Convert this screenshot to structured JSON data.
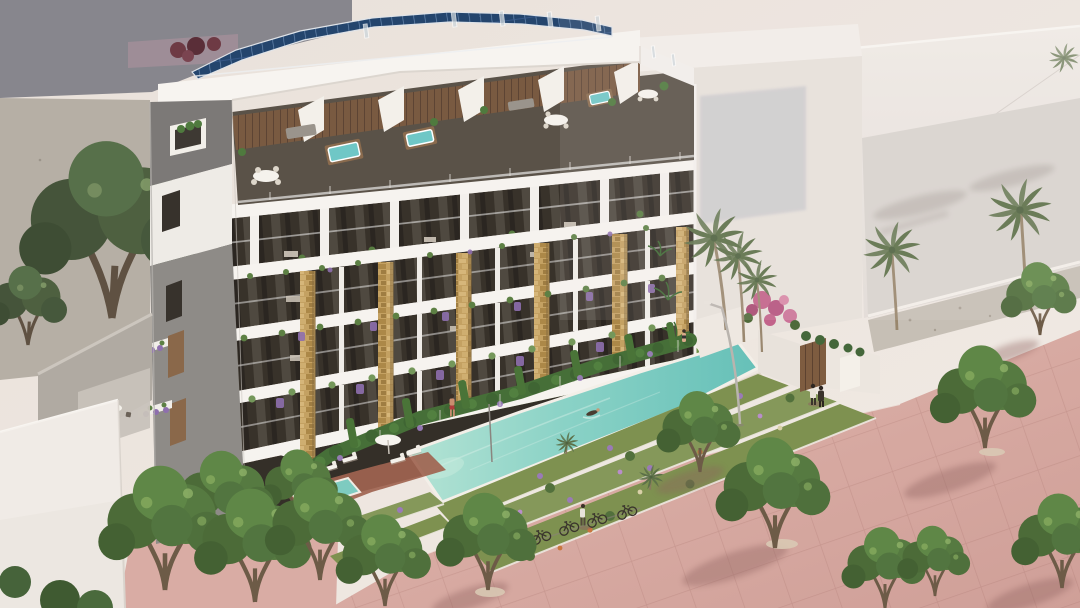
{
  "scene": {
    "title": "New-build apartment complex — aerial artist's impression",
    "description": "Artist's impression of a modern six-storey apartment building seen from above: rooftop solar panels, penthouse terraces with hot tubs and dining sets, balconies with lush planting between stone-clad pillars, a long turquoise lap pool beside a lawn with a swimmer, terraced flower beds, parked bicycles, and a pink-paved promenade with leafy trees and palm trees under a warm hazy sky.",
    "inventory": {
      "building_floors_visible": 6,
      "penthouse_hot_tubs": 3,
      "solar_panel_arrays": 1,
      "swimming_pools": 2,
      "swimmers": 1,
      "people_visible": 6,
      "bicycles": 5,
      "palm_trees": 6,
      "street_lamps": 1,
      "parasols": 3,
      "sun_loungers": 6
    },
    "palette": {
      "sky_haze": "#ece4de",
      "building_white": "#f6f3ef",
      "concrete_grey": "#8e8b87",
      "stone_cladding": "#c4a162",
      "solar_panel_blue": "#24456d",
      "pool_turquoise": "#7ccdc1",
      "lawn_green": "#7d9b4f",
      "tree_green": "#567a41",
      "paving_pink": "#d9aca4",
      "lavender_purple": "#8e6fae",
      "bougainvillea_pink": "#c2638a"
    }
  }
}
